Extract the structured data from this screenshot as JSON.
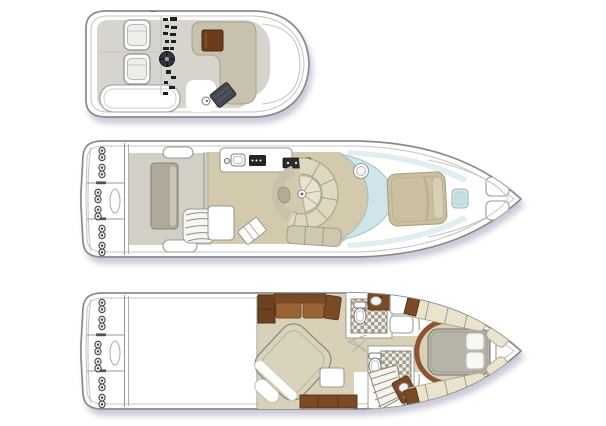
{
  "diagram": {
    "type": "yacht-three-deck-floor-plan",
    "decks": [
      {
        "id": "flybridge",
        "label": "flybridge deck plan"
      },
      {
        "id": "main-deck",
        "label": "main deck plan"
      },
      {
        "id": "lower-deck",
        "label": "lower deck plan"
      }
    ],
    "features": {
      "flybridge": [
        "helm-seats",
        "helm-console",
        "steering-wheel",
        "l-settee",
        "cocktail-table",
        "grill",
        "aft-lounge"
      ],
      "main_deck": [
        "swim-platform",
        "cleats",
        "transom-seat",
        "flybridge-stairs",
        "galley-sink",
        "cooktop",
        "circular-dinette",
        "wraparound-windshield",
        "foredeck-sunpad",
        "bow-hatch",
        "anchor-lockers"
      ],
      "lower_deck": [
        "swim-platform",
        "engine-room",
        "mid-stateroom-bed",
        "l-sofa",
        "aft-head",
        "forward-head",
        "companionway-steps",
        "round-bulkhead",
        "forward-island-berth",
        "flanking-settees"
      ]
    }
  },
  "colors": {
    "bg": "#ffffff",
    "hull_line": "#8a8a8a",
    "hull_inner": "#c6c6c4",
    "white": "#ffffff",
    "line_gray": "#9a9a96",
    "deck_gray": "#d6d4cc",
    "cockpit_floor": "#d2cfc7",
    "seat_gray": "#b0a899",
    "seat_gray_light": "#ccc6b8",
    "settee_taupe": "#c7c1ad",
    "bench_beige": "#ded8c3",
    "floor_tan": "#d3c9ad",
    "floor_tan2": "#d9d0b8",
    "wood": "#7a4a26",
    "wood_dark": "#59371b",
    "wood_mid": "#9a6434",
    "table_brown": "#6b3d1d",
    "glass": "#cfe5ea",
    "glass_edge": "#9dc0c9",
    "sunpad": "#cbbf9f",
    "sunpad_edge": "#ab9f7f",
    "mattress": "#d9d3bd",
    "duvet": "#b7b4a9",
    "cream": "#eae3cd",
    "seam": "#a69d85",
    "dark_object": "#44494f",
    "appliance": "#242424",
    "tile_light": "#f0ede4",
    "tile_dark": "#a29b8e"
  }
}
